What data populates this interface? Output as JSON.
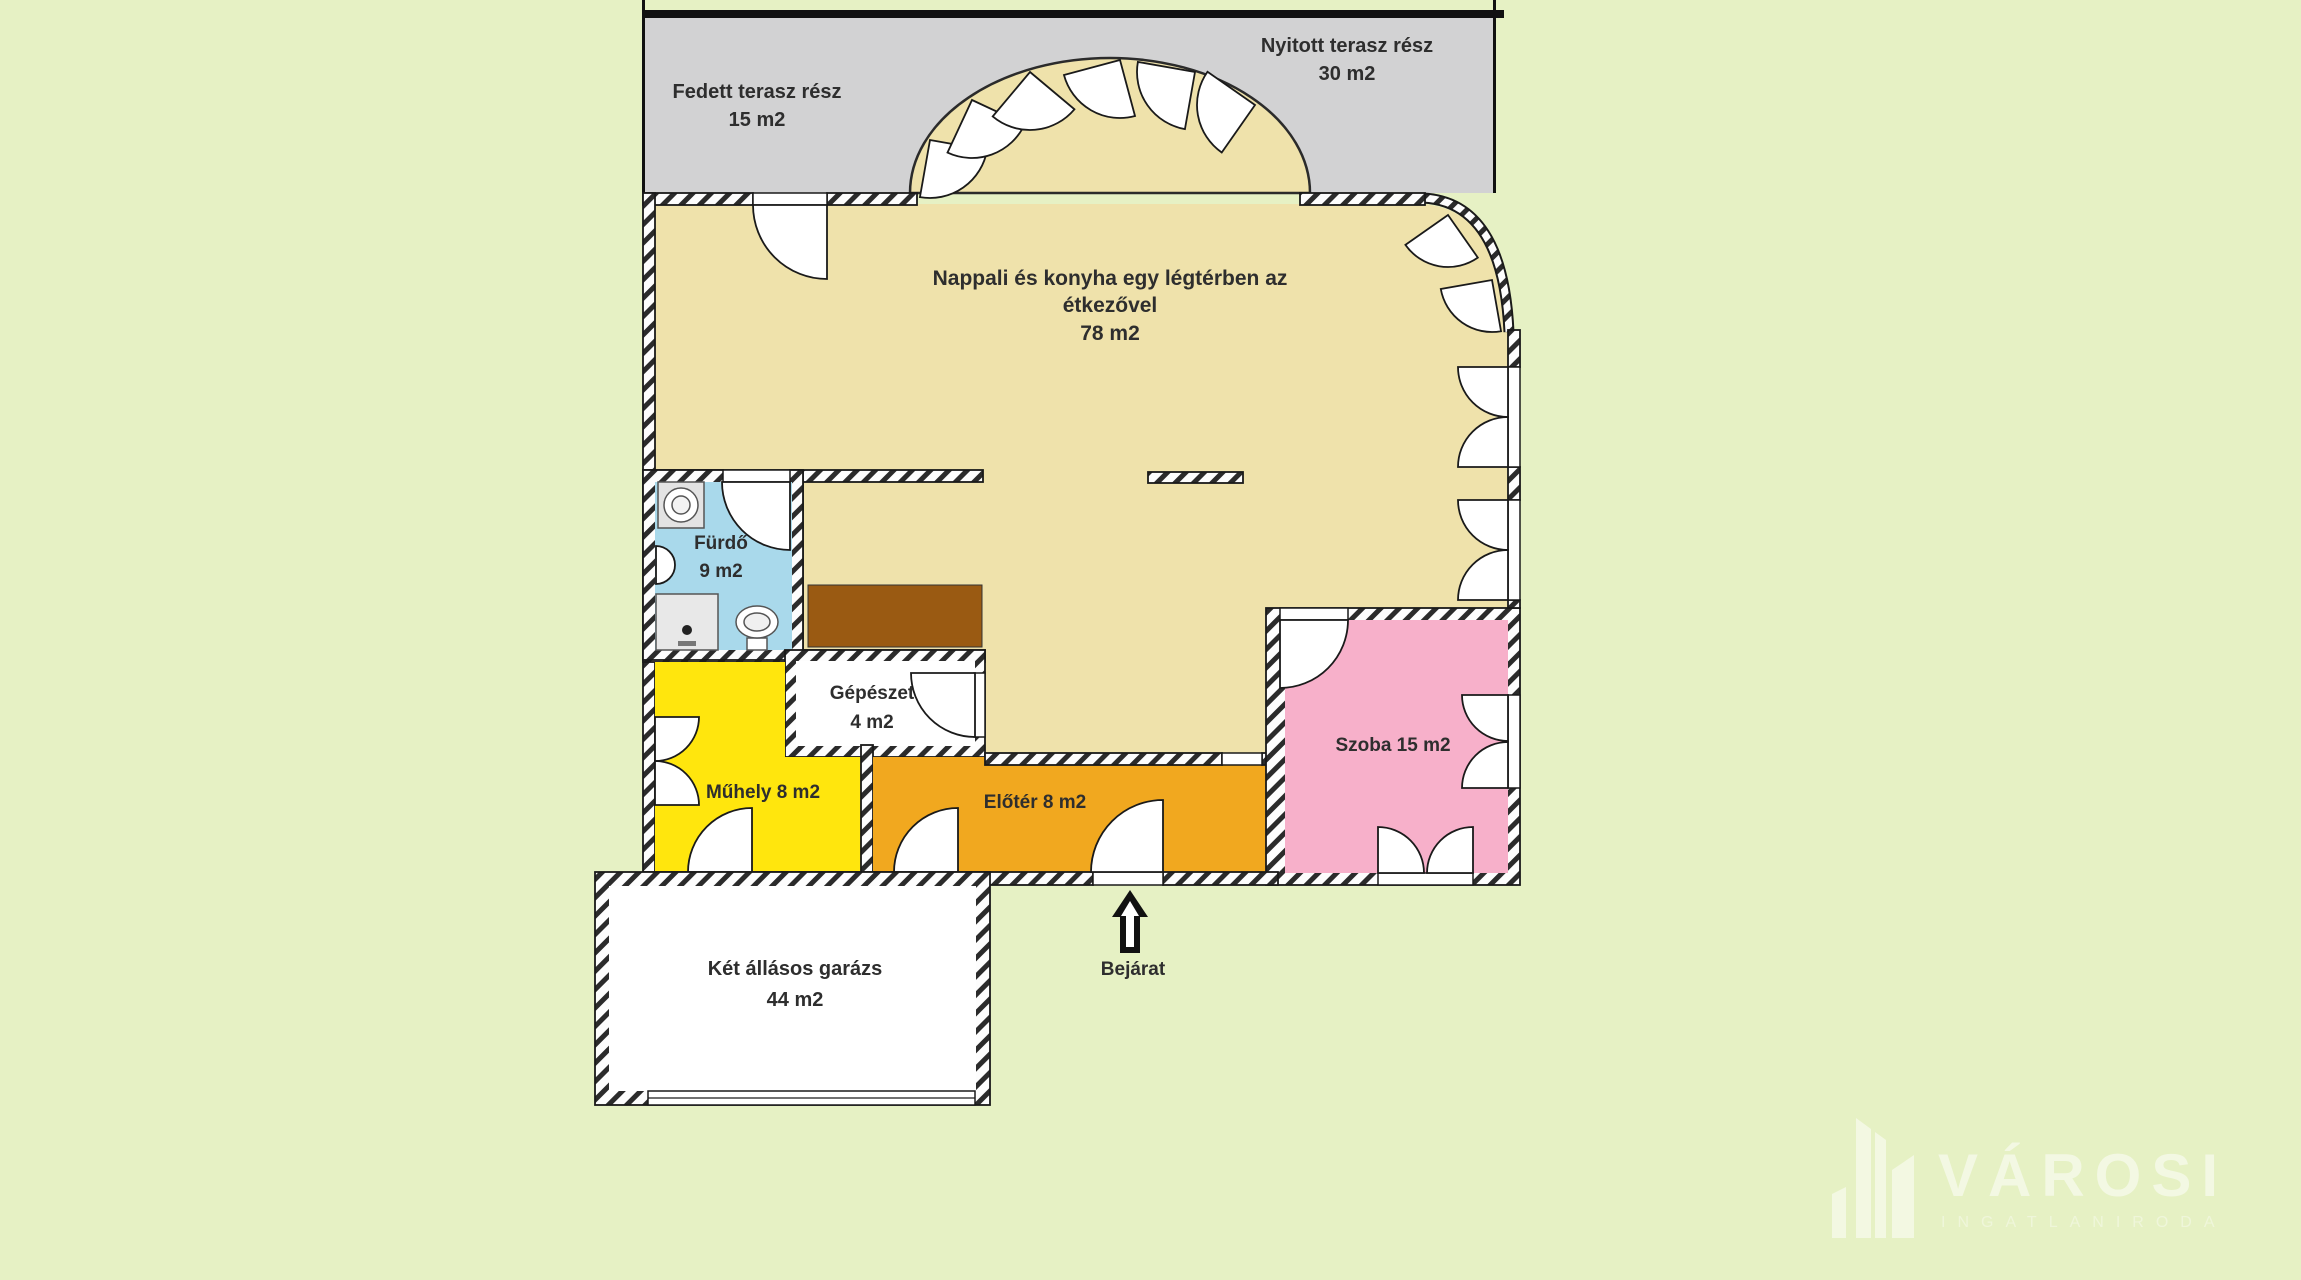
{
  "plan_title": "floor-plan",
  "labels": {
    "fedett1": "Fedett terasz rész",
    "fedett2": "15 m2",
    "nyitott1": "Nyitott terasz rész",
    "nyitott2": "30 m2",
    "nappali1": "Nappali és konyha egy légtérben az",
    "nappali2": "étkezővel",
    "nappali3": "78 m2",
    "furdo1": "Fürdő",
    "furdo2": "9 m2",
    "gepeszet1": "Gépészet",
    "gepeszet2": "4 m2",
    "muhely": "Műhely 8 m2",
    "eloter": "Előtér 8 m2",
    "szoba": "Szoba 15 m2",
    "garazs1": "Két állásos garázs",
    "garazs2": "44 m2",
    "bejarat": "Bejárat"
  },
  "rooms": [
    {
      "name": "covered-terrace",
      "label": "Fedett terasz rész",
      "area": "15 m2",
      "color": "#d2d2d3"
    },
    {
      "name": "open-terrace",
      "label": "Nyitott terasz rész",
      "area": "30 m2",
      "color": "#d2d2d3"
    },
    {
      "name": "living-kitchen-dining",
      "label": "Nappali és konyha egy légtérben az étkezővel",
      "area": "78 m2",
      "color": "#efe2ab"
    },
    {
      "name": "bathroom",
      "label": "Fürdő",
      "area": "9 m2",
      "color": "#a9d9eb"
    },
    {
      "name": "mechanical-room",
      "label": "Gépészet",
      "area": "4 m2",
      "color": "#ffffff"
    },
    {
      "name": "workshop",
      "label": "Műhely",
      "area": "8 m2",
      "color": "#ffe60d"
    },
    {
      "name": "foyer",
      "label": "Előtér",
      "area": "8 m2",
      "color": "#f1a81f"
    },
    {
      "name": "room",
      "label": "Szoba",
      "area": "15 m2",
      "color": "#f7b0ca"
    },
    {
      "name": "garage",
      "label": "Két állásos garázs",
      "area": "44 m2",
      "color": "#ffffff"
    }
  ],
  "entrance": {
    "label": "Bejárat",
    "direction": "up"
  },
  "watermark": {
    "brand": "VÁROSI",
    "subtitle": "INGATLANIRODA"
  },
  "colors": {
    "background": "#e6f1c4",
    "terrace": "#d2d2d3",
    "living": "#efe2ab",
    "bathroom": "#a9d9eb",
    "workshop": "#ffe60d",
    "foyer": "#f1a81f",
    "room": "#f7b0ca",
    "counter": "#9a5a12",
    "wall_line": "#1a1a1a"
  }
}
